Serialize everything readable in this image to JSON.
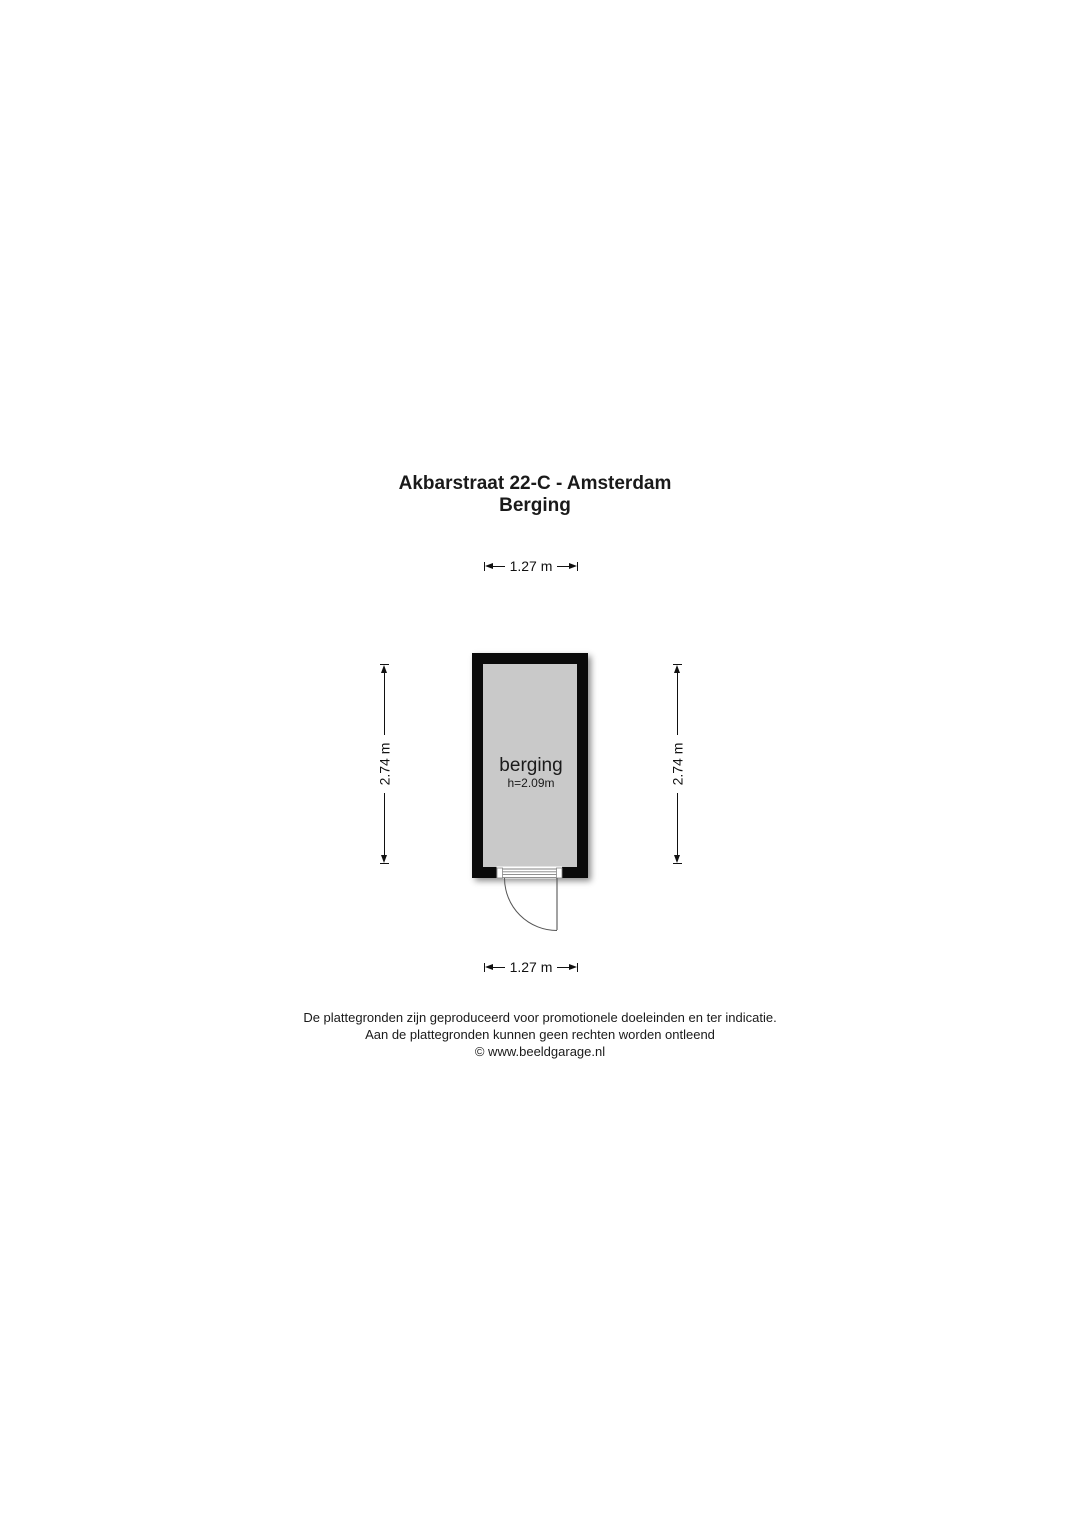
{
  "title": {
    "line1": "Akbarstraat 22-C - Amsterdam",
    "line2": "Berging"
  },
  "floorplan": {
    "room": {
      "name": "berging",
      "ceiling_height": "h=2.09m"
    },
    "dimensions": {
      "width_top": "1.27 m",
      "width_bottom": "1.27 m",
      "height_left": "2.74 m",
      "height_right": "2.74 m"
    },
    "colors": {
      "wall": "#0a0a0a",
      "floor": "#c9c9c9",
      "dimension_line": "#111111",
      "door_line": "#555555"
    }
  },
  "footer": {
    "line1": "De plattegronden zijn geproduceerd voor promotionele doeleinden en ter indicatie.",
    "line2": "Aan de plattegronden kunnen geen rechten worden ontleend",
    "line3": "© www.beeldgarage.nl"
  }
}
